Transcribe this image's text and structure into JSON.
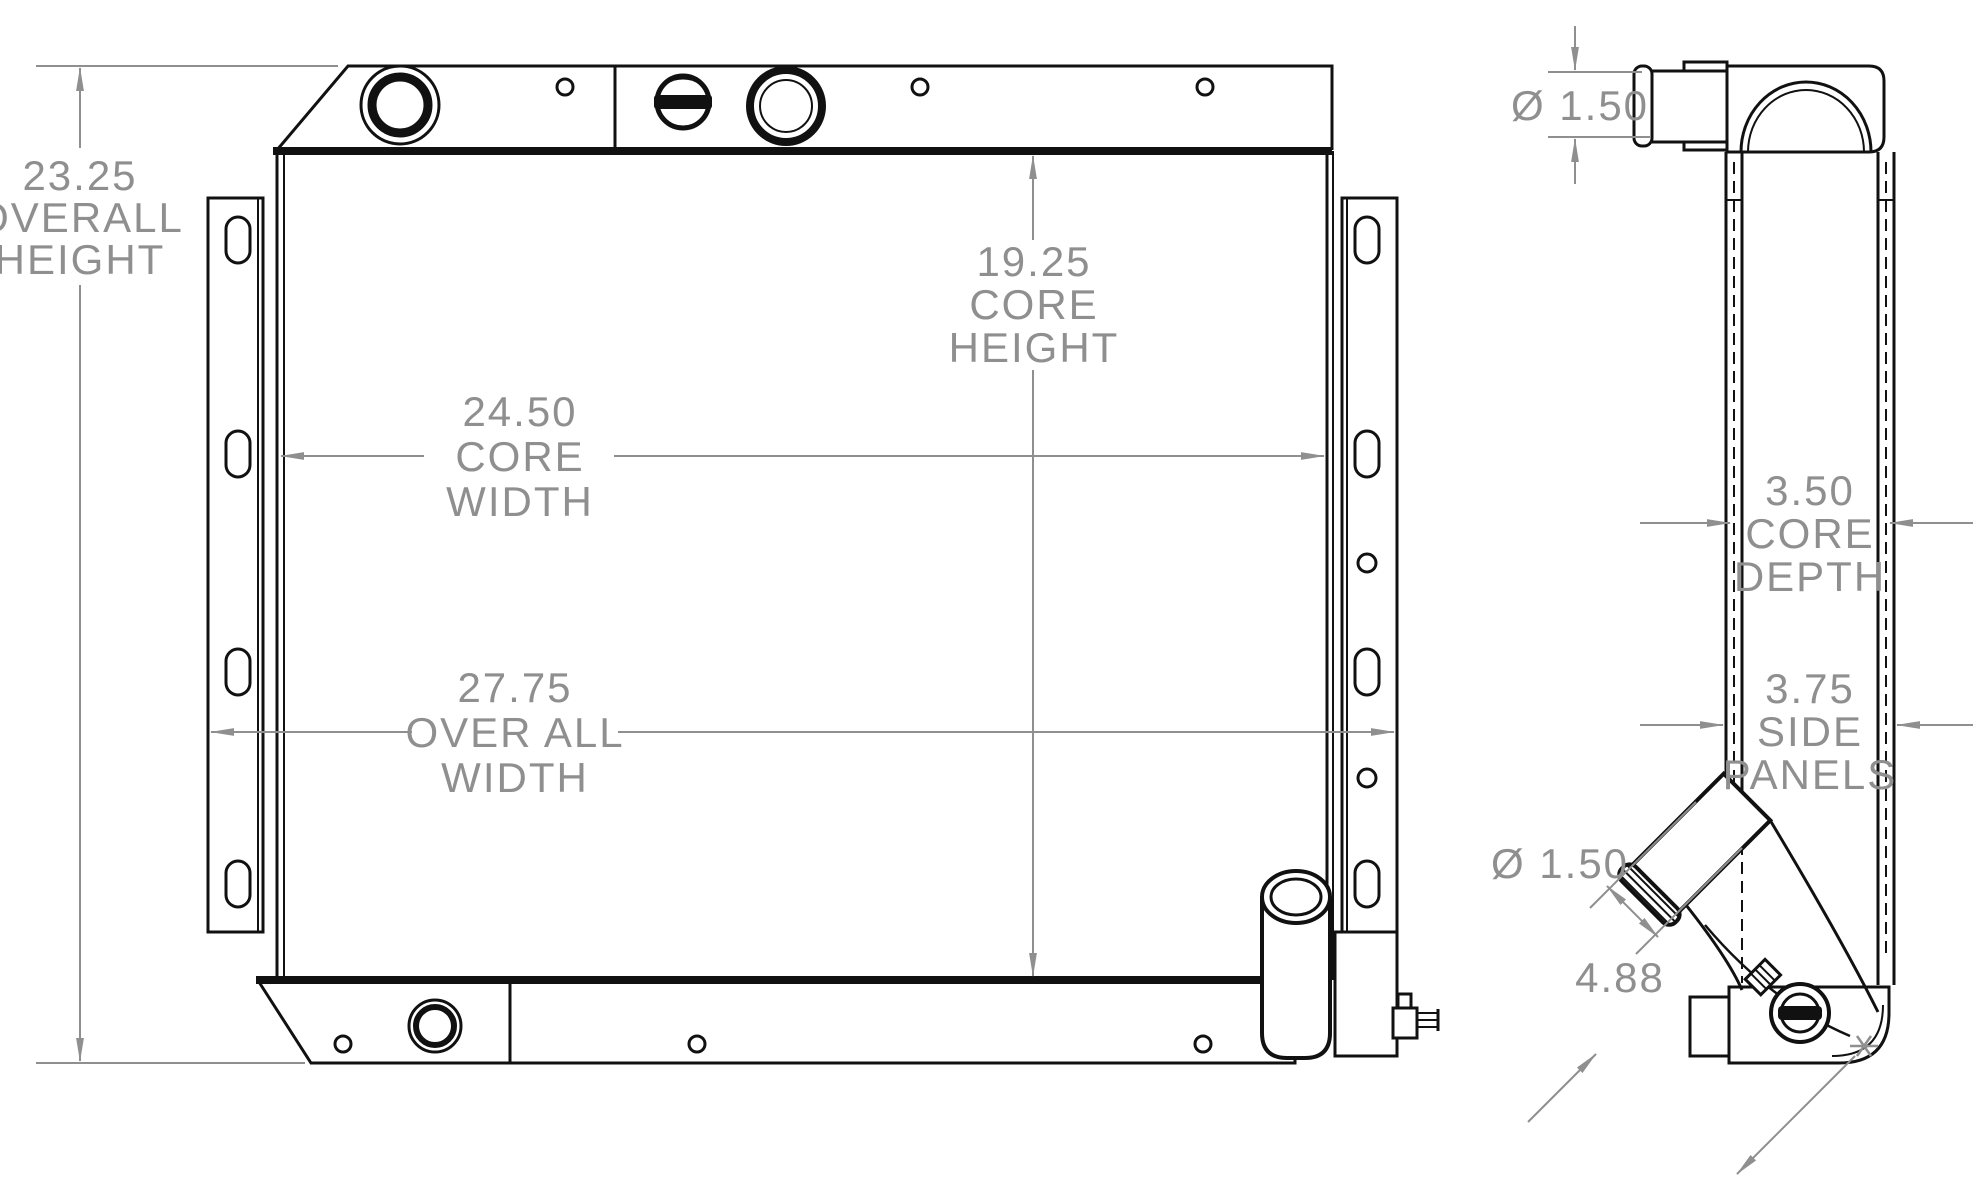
{
  "drawing": {
    "title": "radiator-dimensional-drawing",
    "colors": {
      "line": "#111111",
      "dimension": "#8f8f8f",
      "background": "#ffffff"
    },
    "dimensions": {
      "overall_height": {
        "value": "23.25",
        "line1": "OVERALL",
        "line2": "HEIGHT"
      },
      "core_height": {
        "value": "19.25",
        "line1": "CORE",
        "line2": "HEIGHT"
      },
      "core_width": {
        "value": "24.50",
        "line1": "CORE",
        "line2": "WIDTH"
      },
      "overall_width": {
        "value": "27.75",
        "line1": "OVER ALL",
        "line2": "WIDTH"
      },
      "inlet_diameter": {
        "value": "Ø 1.50"
      },
      "core_depth": {
        "value": "3.50",
        "line1": "CORE",
        "line2": "DEPTH"
      },
      "side_panels": {
        "value": "3.75",
        "line1": "SIDE",
        "line2": "PANELS"
      },
      "outlet_diameter": {
        "value": "Ø 1.50"
      },
      "outlet_length": {
        "value": "4.88"
      }
    }
  }
}
